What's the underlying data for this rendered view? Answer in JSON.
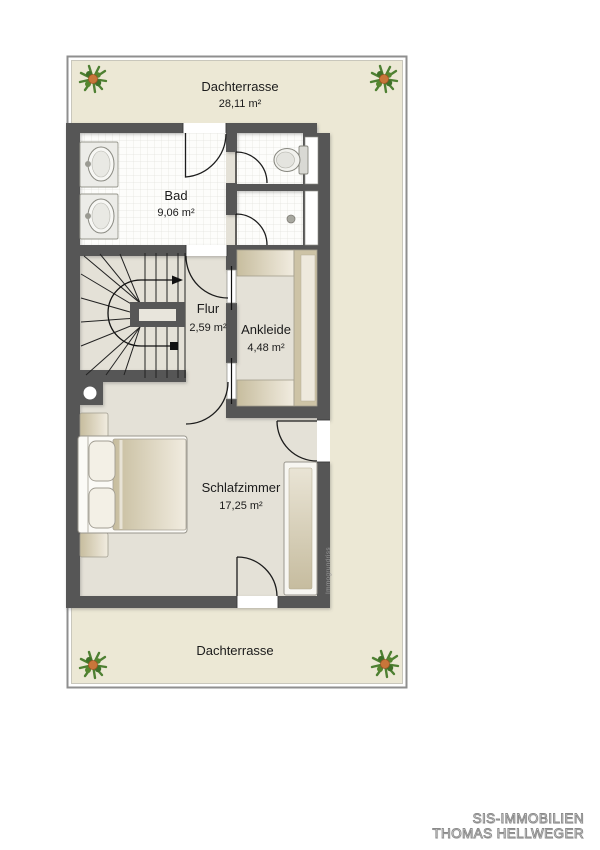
{
  "plan": {
    "terrace_top": {
      "label": "Dachterrasse",
      "area": "28,11 m²"
    },
    "terrace_bottom": {
      "label": "Dachterrasse"
    },
    "rooms": {
      "bad": {
        "label": "Bad",
        "area": "9,06 m²"
      },
      "flur": {
        "label": "Flur",
        "area": "2,59 m²"
      },
      "ankleide": {
        "label": "Ankleide",
        "area": "4,48 m²"
      },
      "schlafzimmer": {
        "label": "Schlafzimmer",
        "area": "17,25 m²"
      }
    },
    "watermark": "Immogrundriss"
  },
  "footer": {
    "line1": "SIS-IMMOBILIEN",
    "line2": "THOMAS HELLWEGER"
  },
  "colors": {
    "wall": "#575757",
    "terrace": "#ece8d5",
    "floor": "#e4e1d7",
    "tile": "#fdfdfb",
    "furniture_tan": "#cdc3a6",
    "plant_green": "#4e8032",
    "plant_center": "#c8763a"
  }
}
